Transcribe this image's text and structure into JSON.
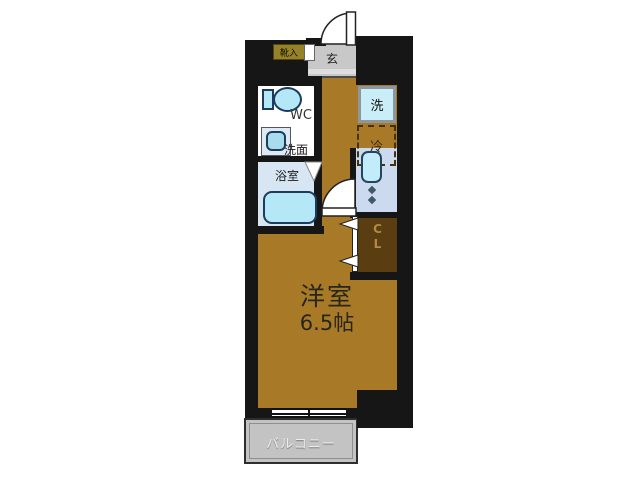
{
  "plan": {
    "entrance": {
      "label": "玄"
    },
    "shoe_storage": {
      "label": "靴入"
    },
    "toilet": {
      "label": "WC"
    },
    "washbasin": {
      "label": "洗面"
    },
    "bathroom": {
      "label": "浴室"
    },
    "washer": {
      "label": "洗"
    },
    "refrigerator": {
      "label": "冷"
    },
    "closet": {
      "line1": "C",
      "line2": "L"
    },
    "main_room": {
      "name": "洋室",
      "size": "6.5帖"
    },
    "balcony": {
      "label": "バルコニー"
    },
    "colors": {
      "wall": "#161616",
      "room_floor": "#a87a28",
      "closet_floor": "#5a3e12",
      "bathroom_floor": "#d8e6f4",
      "entrance_floor": "#c8c8c8",
      "balcony_floor": "#c3c3c3",
      "fixture_fill": "#b4e8f6",
      "counter_fill": "#ccdaf0",
      "shoe_box_fill": "#97822a"
    }
  }
}
